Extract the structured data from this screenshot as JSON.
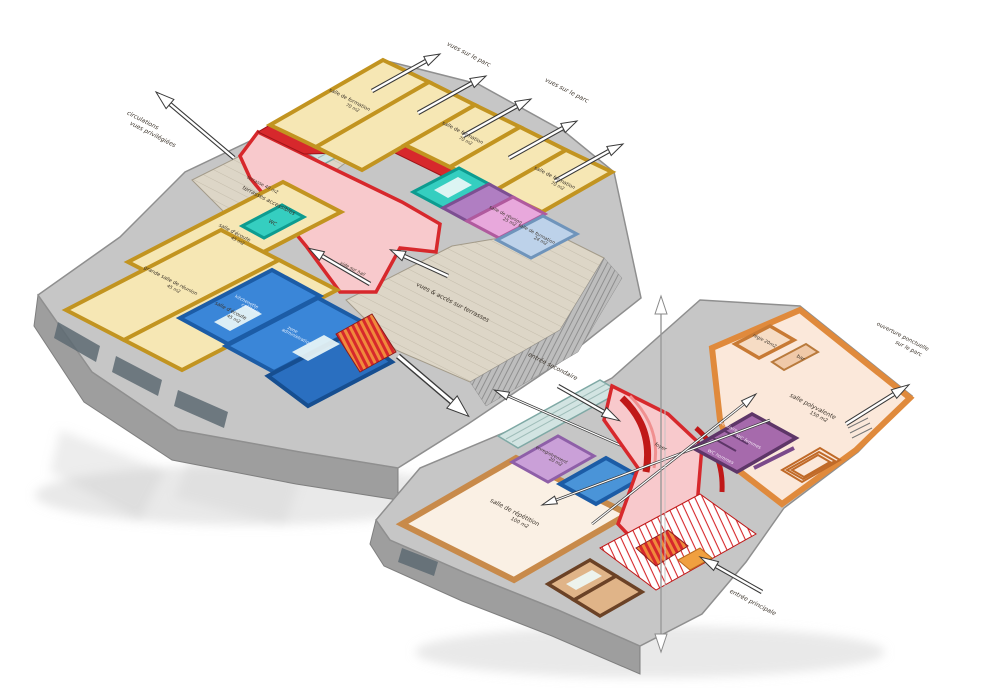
{
  "diagram": {
    "kind": "axonometric-floor-plans",
    "palette": {
      "circulation_red": "#d7282c",
      "circulation_pink_floor": "#f8c9cc",
      "training_yellow": "#f6e7b4",
      "admin_blue": "#3a86d8",
      "wc_teal": "#35cec0",
      "meeting_magenta": "#e8a8dc",
      "meeting_violet": "#b07ec2",
      "meeting_lightblue": "#bdd2ea",
      "hall_orange": "#e08a3c",
      "services_purple": "#a66aac",
      "shell_gray": "#c6c6c6",
      "deck_wood": "#ddd6c7"
    }
  },
  "upper": {
    "rooms": {
      "formation": {
        "label": "salle de formation",
        "area": "70 m2"
      },
      "ecoute": {
        "label": "salle d'écoute",
        "area": "45 m2"
      },
      "grande_reunion": {
        "label": "grande salle de réunion",
        "area": "45 m2"
      },
      "reunion": {
        "label": "salle de réunion",
        "area": "25 m2"
      },
      "formation_s": {
        "label": "salle de formation",
        "area": "24 m2"
      },
      "wc": {
        "label": "WC"
      },
      "kitchenette": {
        "label": "kitchenette",
        "label2": "cafétéria"
      },
      "administration": {
        "label": "zone",
        "label2": "administration"
      },
      "vide": {
        "label": "vide sur hall"
      }
    },
    "deck": {
      "terrasse": "terrasse 40 m2",
      "terrasses": "terrasses accessibles",
      "vues_acces": "vues & accès sur terrasses"
    },
    "annotations": {
      "circulations": "circulations",
      "circulations2": "vues privilégiées",
      "vues_parc": "vues sur le parc"
    }
  },
  "lower": {
    "rooms": {
      "repetition": {
        "label": "salle de répétition",
        "area": "100 m2"
      },
      "enregistrement": {
        "label": "enregistrement",
        "area": "20 m2"
      },
      "polyvalente": {
        "label": "salle polyvalente",
        "area": "150 m2"
      },
      "regie": {
        "label": "régie 20m2"
      },
      "bar": {
        "label": "bar"
      },
      "vestiaire": {
        "label": "vestiaire"
      },
      "wc_femmes": {
        "label": "WC femmes"
      },
      "wc_hommes": {
        "label": "WC hommes"
      },
      "foyer": {
        "label": "foyer"
      }
    },
    "annotations": {
      "entree_secondaire": "entrée secondaire",
      "entree_principale": "entrée principale",
      "ouverture": "ouverture ponctuelle",
      "ouverture2": "sur le parc"
    }
  }
}
